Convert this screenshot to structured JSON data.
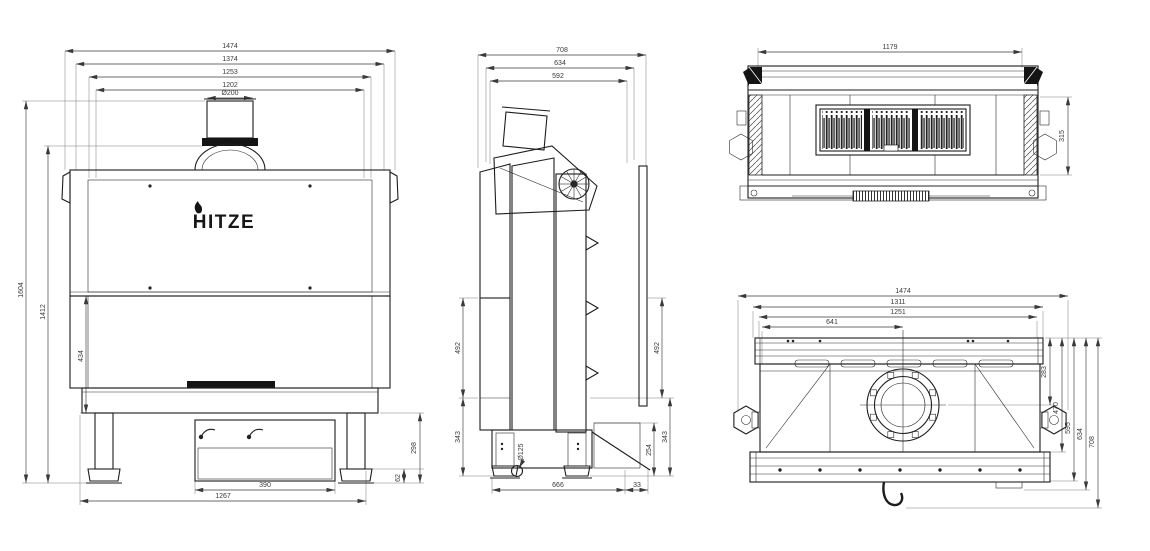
{
  "brand": "HITZE",
  "views": {
    "front": {
      "dims": {
        "overall_width": "1474",
        "body_width": "1374",
        "frame_width": "1253",
        "opening_width": "1202",
        "flue_diameter": "Ø200",
        "overall_height": "1604",
        "body_height": "1412",
        "glass_height": "434",
        "drawer_width": "390",
        "base_width": "1267",
        "base_height": "298",
        "foot_height": "62"
      }
    },
    "side": {
      "dims": {
        "overall_depth": "708",
        "body_depth": "634",
        "inner_depth": "592",
        "upper_height_left": "492",
        "upper_height_right": "492",
        "lower_height_left": "343",
        "lower_height_right": "343",
        "ledge_height": "254",
        "intake_diameter": "Ø125",
        "base_depth": "666",
        "rear_offset": "33"
      }
    },
    "top": {
      "dims": {
        "grille_width": "1179",
        "grille_depth": "315"
      }
    },
    "rear": {
      "dims": {
        "overall_width": "1474",
        "body_width": "1311",
        "inner_width": "1251",
        "flue_center_from_left": "641",
        "flue_center_depth": "283",
        "panel_depth": "470",
        "ledge_depth": "595",
        "body_depth": "634",
        "overall_depth": "708"
      }
    }
  }
}
